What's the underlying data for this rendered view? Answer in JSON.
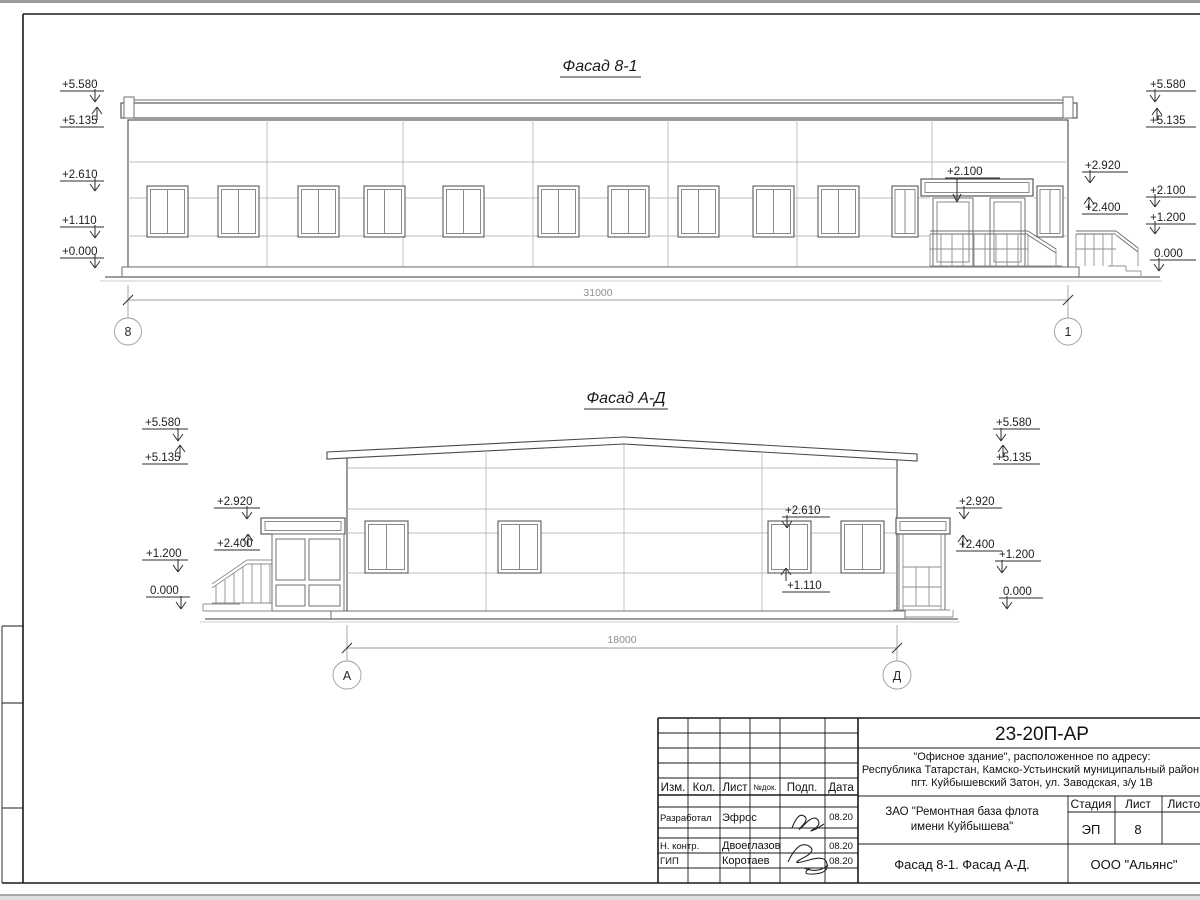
{
  "colors": {
    "paper": "#ffffff",
    "line_dark": "#1a1a1a",
    "line_main": "#4a4a4a",
    "line_light": "#bdbdbd"
  },
  "facade1": {
    "title": "Фасад 8-1",
    "dimension": "31000",
    "axis_left": "8",
    "axis_right": "1",
    "entrance_mark": "+2.100",
    "marks_left": [
      "+5.580",
      "+5.135",
      "+2.610",
      "+1.110",
      "+0.000"
    ],
    "marks_right_near": [
      "+2.920",
      "+2.400"
    ],
    "marks_right_far": [
      "+5.580",
      "+5.135",
      "+2.100",
      "+1.200",
      "0.000"
    ]
  },
  "facade2": {
    "title": "Фасад А-Д",
    "dimension": "18000",
    "axis_left": "А",
    "axis_right": "Д",
    "marks_left_far": [
      "+5.580",
      "+5.135",
      "+1.200",
      "0.000"
    ],
    "marks_left_near": [
      "+2.920",
      "+2.400"
    ],
    "marks_right_near": [
      "+2.920",
      "+2.400"
    ],
    "marks_right_far": [
      "+5.580",
      "+5.135",
      "+1.200",
      "0.000"
    ],
    "window_marks": [
      "+2.610",
      "+1.110"
    ]
  },
  "stamp": {
    "doc_number": "23-20П-АР",
    "address_lines": [
      "\"Офисное здание\", расположенное по адресу:",
      "Республика Татарстан, Камско-Устьинский муниципальный район,",
      "пгт. Куйбышевский Затон, ул. Заводская, з/у 1В"
    ],
    "client_lines": [
      "ЗАО \"Ремонтная база флота",
      "имени Куйбышева\""
    ],
    "columns": [
      "Изм.",
      "Кол.",
      "Лист",
      "№док.",
      "Подп.",
      "Дата"
    ],
    "rows": [
      {
        "role": "Разработал",
        "name": "Эфрос",
        "date": "08.20"
      },
      {
        "role": "Н. контр.",
        "name": "Двоеглазов",
        "date": "08.20"
      },
      {
        "role": "ГИП",
        "name": "Коротаев",
        "date": "08.20"
      }
    ],
    "stage_label": "Стадия",
    "sheet_label": "Лист",
    "sheets_label": "Листов",
    "stage_value": "ЭП",
    "sheet_value": "8",
    "drawing_title": "Фасад 8-1. Фасад А-Д.",
    "company": "ООО \"Альянс\""
  }
}
